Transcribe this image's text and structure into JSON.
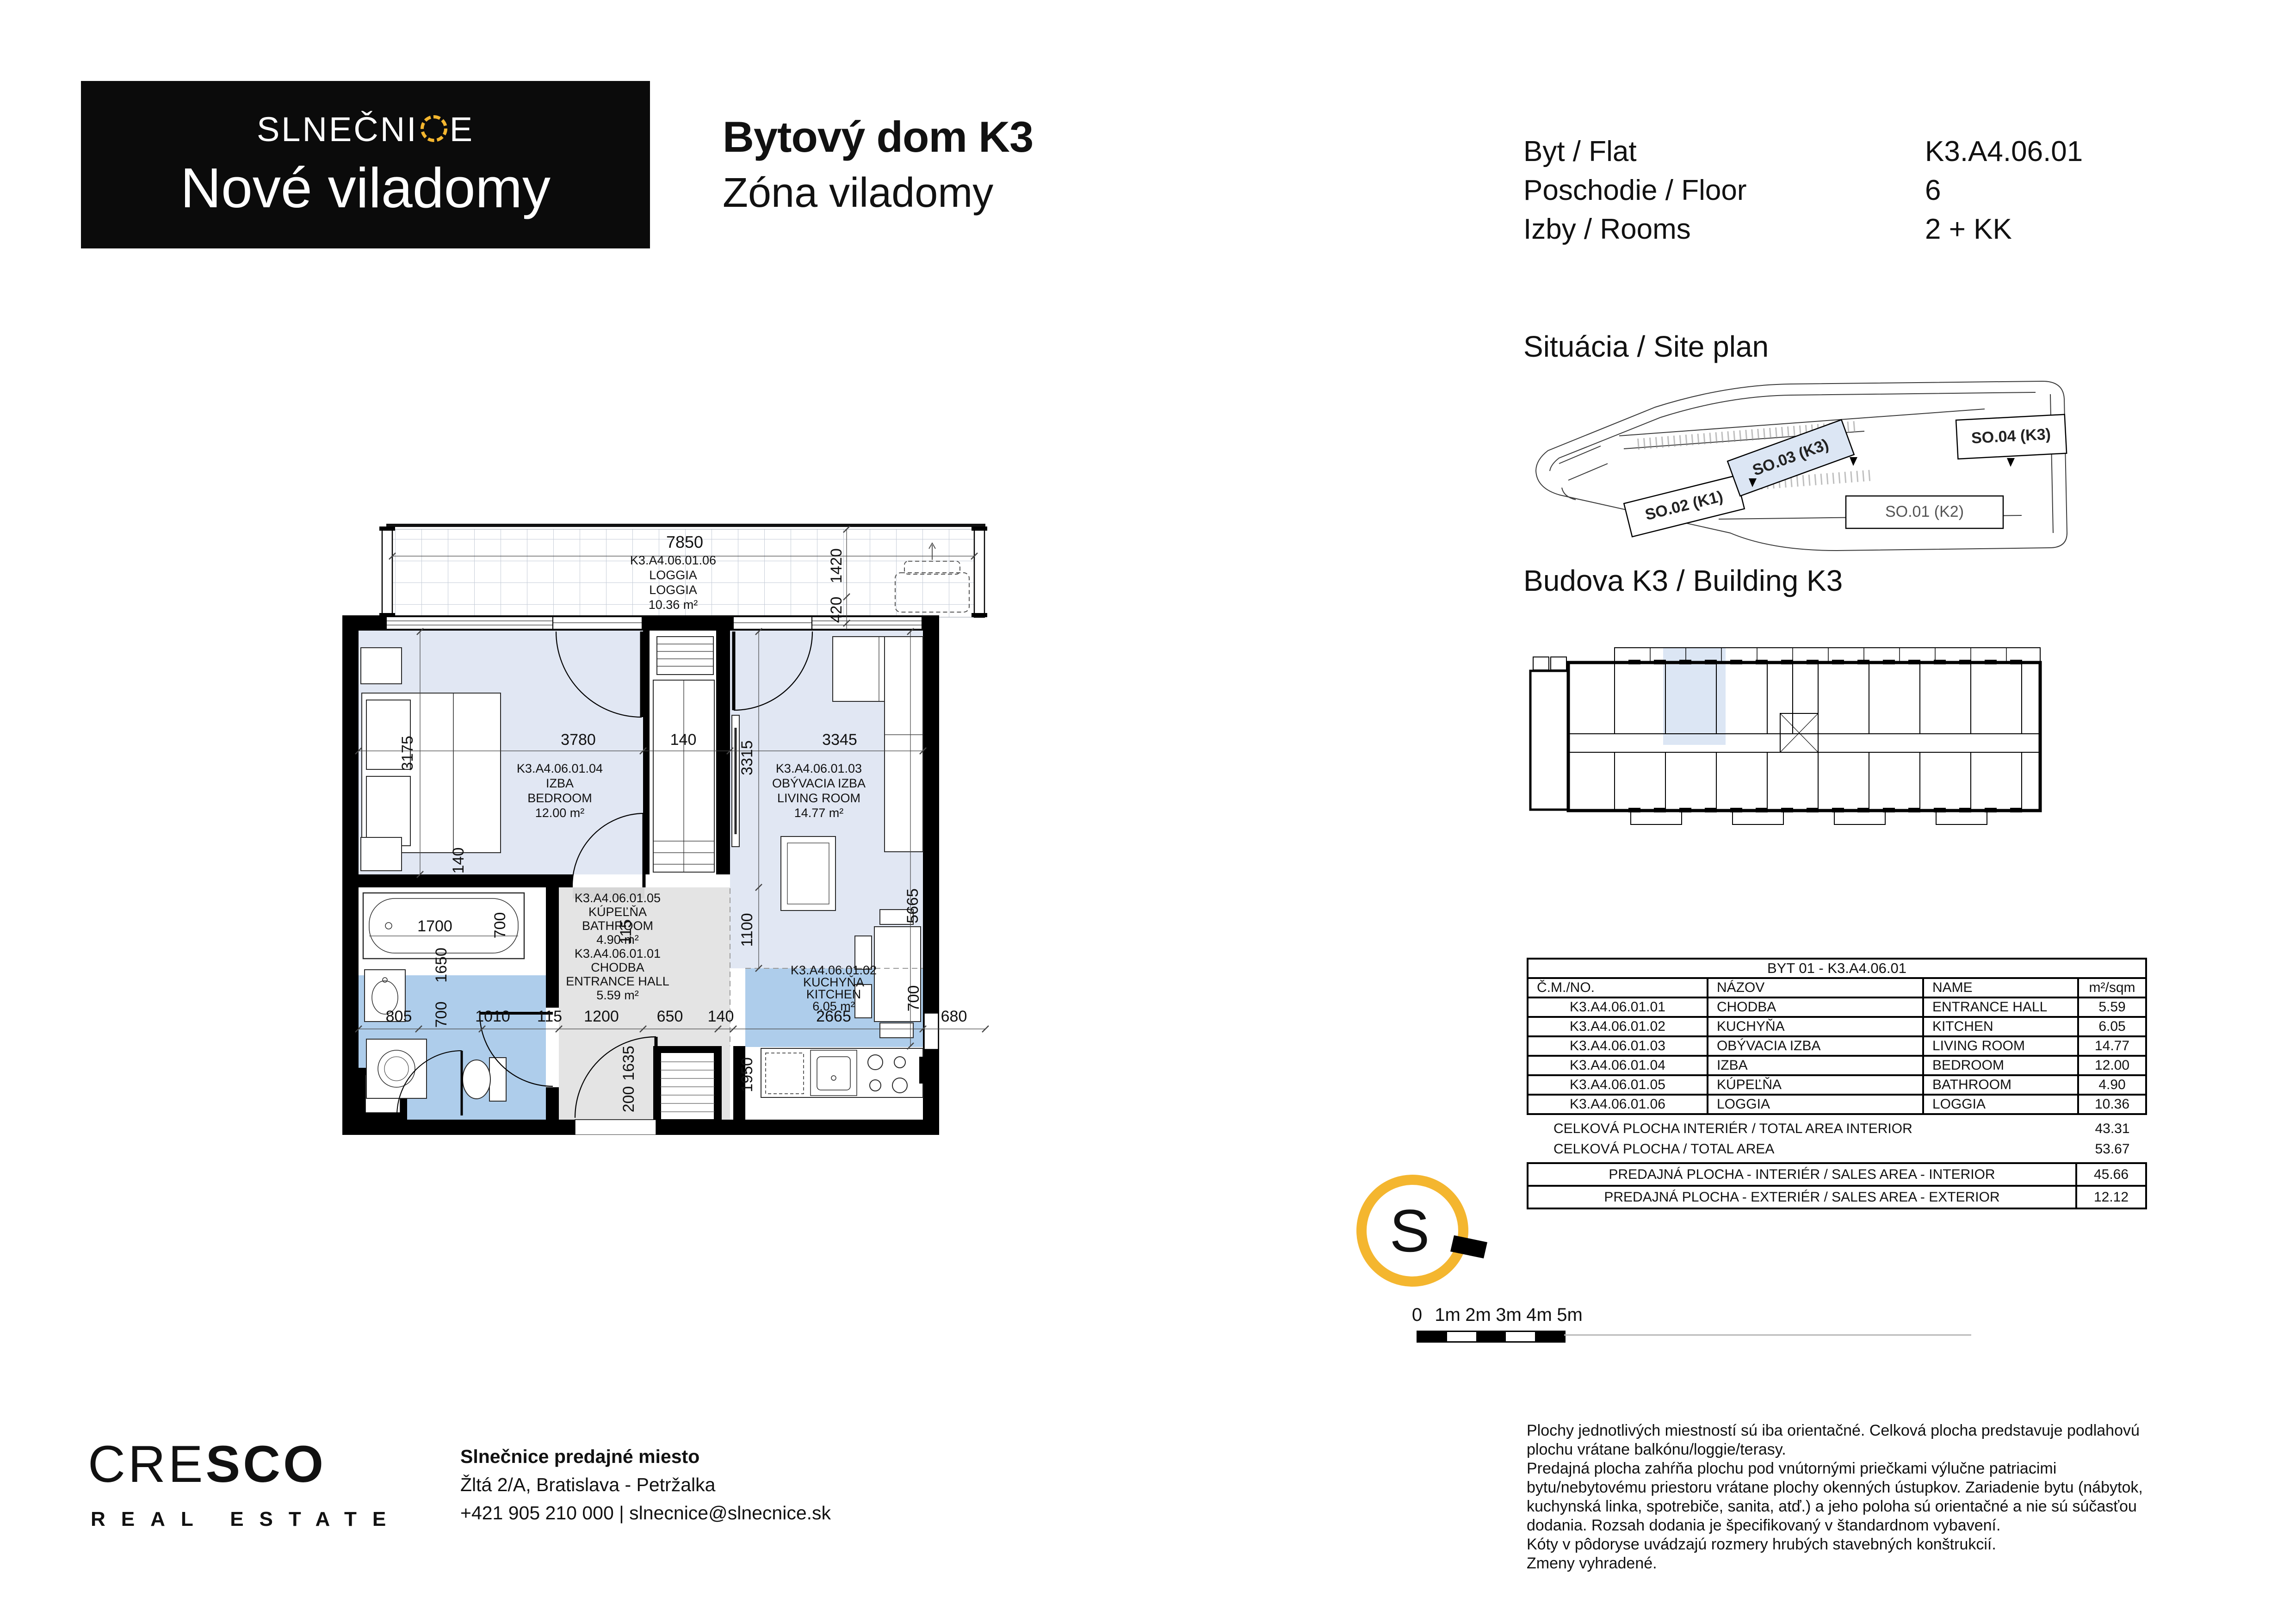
{
  "logo": {
    "brand_pre": "SLNEČNI",
    "brand_post": "E",
    "subtitle": "Nové viladomy"
  },
  "header": {
    "title": "Bytový dom K3",
    "subtitle": "Zóna viladomy"
  },
  "flat_info": {
    "rows": [
      {
        "label": "Byt / Flat",
        "value": "K3.A4.06.01"
      },
      {
        "label": "Poschodie / Floor",
        "value": "6"
      },
      {
        "label": "Izby / Rooms",
        "value": "2 + KK"
      }
    ]
  },
  "sections": {
    "site_plan": "Situácia / Site plan",
    "building": "Budova K3 / Building K3"
  },
  "site_plan": {
    "buildings": [
      {
        "label": "SO.02 (K1)",
        "highlight": false
      },
      {
        "label": "SO.03 (K3)",
        "highlight": true
      },
      {
        "label": "SO.04 (K3)",
        "highlight": false
      },
      {
        "label": "SO.01 (K2)",
        "highlight": false
      }
    ]
  },
  "plan": {
    "rooms": {
      "loggia": {
        "code": "K3.A4.06.01.06",
        "sk": "LOGGIA",
        "en": "LOGGIA",
        "area": "10.36 m²"
      },
      "bedroom": {
        "code": "K3.A4.06.01.04",
        "sk": "IZBA",
        "en": "BEDROOM",
        "area": "12.00 m²"
      },
      "living": {
        "code": "K3.A4.06.01.03",
        "sk": "OBÝVACIA IZBA",
        "en": "LIVING ROOM",
        "area": "14.77 m²"
      },
      "bathroom": {
        "code": "K3.A4.06.01.05",
        "sk": "KÚPEĽŇA",
        "en": "BATHROOM",
        "area": "4.90 m²"
      },
      "hall": {
        "code": "K3.A4.06.01.01",
        "sk": "CHODBA",
        "en": "ENTRANCE HALL",
        "area": "5.59 m²"
      },
      "kitchen": {
        "code": "K3.A4.06.01.02",
        "sk": "KUCHYŇA",
        "en": "KITCHEN",
        "area": "6.05 m²"
      }
    },
    "dims": {
      "loggia_w": "7850",
      "loggia_d": "1420",
      "loggia_wall": "420",
      "bedroom_w": "3780",
      "mid_wall": "140",
      "living_w": "3345",
      "bedroom_h": "3175",
      "bedroom_wall": "140",
      "living_h": "3315",
      "living_low": "1100",
      "hall_115": "115",
      "living_total": "5665",
      "tub_len": "1700",
      "tub_w": "700",
      "bath_wall": "1650",
      "wc_w": "700",
      "c1": "805",
      "c2": "1010",
      "c3": "115",
      "c4": "1200",
      "c5": "650",
      "c6": "140",
      "c7": "2665",
      "c8": "680",
      "shaft_h": "1635",
      "shaft_s": "200",
      "kitchen_h": "1950",
      "kitchen_w700": "700"
    }
  },
  "table": {
    "title": "BYT 01 - K3.A4.06.01",
    "headers": [
      "Č.M./NO.",
      "NÁZOV",
      "NAME",
      "m²/sqm"
    ],
    "rows": [
      {
        "no": "K3.A4.06.01.01",
        "sk": "CHODBA",
        "en": "ENTRANCE HALL",
        "area": "5.59"
      },
      {
        "no": "K3.A4.06.01.02",
        "sk": "KUCHYŇA",
        "en": "KITCHEN",
        "area": "6.05"
      },
      {
        "no": "K3.A4.06.01.03",
        "sk": "OBÝVACIA IZBA",
        "en": "LIVING ROOM",
        "area": "14.77"
      },
      {
        "no": "K3.A4.06.01.04",
        "sk": "IZBA",
        "en": "BEDROOM",
        "area": "12.00"
      },
      {
        "no": "K3.A4.06.01.05",
        "sk": "KÚPEĽŇA",
        "en": "BATHROOM",
        "area": "4.90"
      },
      {
        "no": "K3.A4.06.01.06",
        "sk": "LOGGIA",
        "en": "LOGGIA",
        "area": "10.36"
      }
    ],
    "totals": [
      {
        "label": "CELKOVÁ PLOCHA INTERIÉR / TOTAL AREA INTERIOR",
        "value": "43.31"
      },
      {
        "label": "CELKOVÁ PLOCHA / TOTAL AREA",
        "value": "53.67"
      },
      {
        "label": "PREDAJNÁ PLOCHA - INTERIÉR / SALES AREA - INTERIOR",
        "value": "45.66"
      },
      {
        "label": "PREDAJNÁ PLOCHA - EXTERIÉR / SALES AREA - EXTERIOR",
        "value": "12.12"
      }
    ]
  },
  "compass": {
    "letter": "S"
  },
  "scale_bar": {
    "labels": [
      "0",
      "1m",
      "2m",
      "3m",
      "4m",
      "5m"
    ]
  },
  "footer": {
    "cresco_thin": "CRE",
    "cresco_bold": "SCO",
    "cresco_sub": "REAL ESTATE",
    "contact": [
      "Slnečnice predajné miesto",
      "Žltá 2/A, Bratislava - Petržalka",
      "+421 905 210 000 | slnecnice@slnecnice.sk"
    ],
    "disclaimer": [
      "Plochy jednotlivých miestností sú iba orientačné. Celková plocha predstavuje podlahovú",
      "plochu vrátane balkónu/loggie/terasy.",
      "Predajná plocha zahŕňa plochu pod vnútornými priečkami výlučne patriacimi",
      "bytu/nebytovému priestoru vrátane plochy okenných ústupkov. Zariadenie bytu (nábytok,",
      "kuchynská linka, spotrebiče, sanita, atď.) a jeho poloha sú orientačné a nie sú súčasťou",
      "dodania. Rozsah dodania je špecifikovaný v štandardnom vybavení.",
      "Kóty v pôdoryse uvádzajú rozmery hrubých stavebných konštrukcií.",
      "Zmeny vyhradené."
    ]
  },
  "colors": {
    "accent_yellow": "#F4B62F",
    "room_pale": "#e1e7f3",
    "room_blue": "#aecdeb",
    "hall_gray": "#e4e4e4",
    "highlight": "#dce6f4"
  }
}
